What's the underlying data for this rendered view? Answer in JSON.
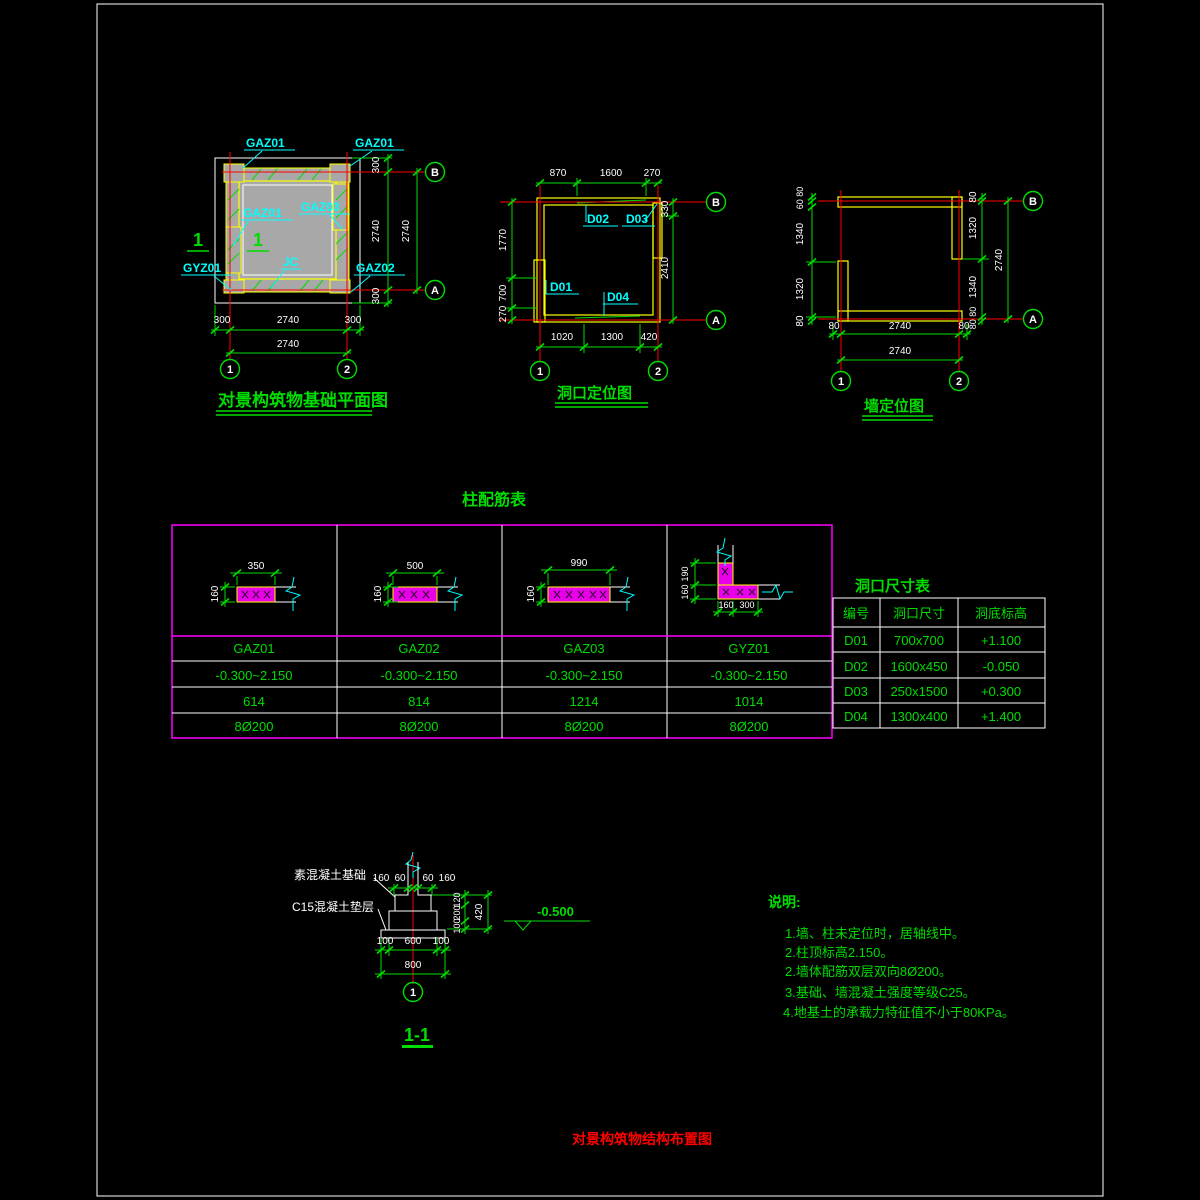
{
  "colors": {
    "background": "#000000",
    "green": "#00dd00",
    "cyan": "#00ffff",
    "red": "#ff0000",
    "yellow": "#ffff00",
    "magenta": "#ff00ff",
    "white": "#ffffff",
    "wall_gray": "#a8a8a8",
    "section_pink": "#e800e8"
  },
  "plans": {
    "foundation": {
      "title": "对景构筑物基础平面图",
      "labels": {
        "gaz01": "GAZ01",
        "gaz02": "GAZ02",
        "gaz03": "GAZ03",
        "gyz01": "GYZ01",
        "jc": "JC"
      },
      "section_mark": "1",
      "right_dims": [
        "300",
        "2740",
        "300"
      ],
      "right_total": "2740",
      "bottom_dims": [
        "300",
        "2740",
        "300"
      ],
      "bottom_total": "2740",
      "axes": {
        "a": "A",
        "b": "B",
        "n1": "1",
        "n2": "2"
      }
    },
    "opening": {
      "title": "洞口定位图",
      "top_dims": [
        "870",
        "1600",
        "270"
      ],
      "left_dims": [
        "1770",
        "700",
        "270"
      ],
      "right_dims": [
        "330",
        "2410"
      ],
      "bottom_dims": [
        "1020",
        "1300",
        "420"
      ],
      "doors": {
        "d01": "D01",
        "d02": "D02",
        "d03": "D03",
        "d04": "D04"
      },
      "axes": {
        "a": "A",
        "b": "B",
        "n1": "1",
        "n2": "2"
      }
    },
    "wall": {
      "title": "墙定位图",
      "left_dims": [
        "60 80",
        "1340",
        "1320",
        "80"
      ],
      "right_dims": [
        "80",
        "1320",
        "1340",
        "80 80"
      ],
      "right_total": "2740",
      "bottom_dims": [
        "80",
        "2740",
        "80"
      ],
      "bottom_total": "2740",
      "axes": {
        "a": "A",
        "b": "B",
        "n1": "1",
        "n2": "2"
      }
    }
  },
  "column_table": {
    "title": "柱配筋表",
    "columns": [
      {
        "name": "GAZ01",
        "width": "350",
        "height": "160",
        "range": "-0.300~2.150",
        "bars": "614",
        "stirrups": "8Ø200"
      },
      {
        "name": "GAZ02",
        "width": "500",
        "height": "160",
        "range": "-0.300~2.150",
        "bars": "814",
        "stirrups": "8Ø200"
      },
      {
        "name": "GAZ03",
        "width": "990",
        "height": "160",
        "range": "-0.300~2.150",
        "bars": "1214",
        "stirrups": "8Ø200"
      },
      {
        "name": "GYZ01",
        "v_dims": [
          "190",
          "160"
        ],
        "h_dims": [
          "160",
          "300"
        ],
        "range": "-0.300~2.150",
        "bars": "1014",
        "stirrups": "8Ø200"
      }
    ]
  },
  "opening_table": {
    "title": "洞口尺寸表",
    "headers": [
      "编号",
      "洞口尺寸",
      "洞底标高"
    ],
    "rows": [
      {
        "id": "D01",
        "size": "700x700",
        "elev": "+1.100"
      },
      {
        "id": "D02",
        "size": "1600x450",
        "elev": "-0.050"
      },
      {
        "id": "D03",
        "size": "250x1500",
        "elev": "+0.300"
      },
      {
        "id": "D04",
        "size": "1300x400",
        "elev": "+1.400"
      }
    ]
  },
  "section": {
    "title": "1-1",
    "label_footing": "素混凝土基础",
    "label_cushion": "C15混凝土垫层",
    "top_dims": [
      "160",
      "60",
      "60",
      "160"
    ],
    "right_dims": [
      "120",
      "200",
      "100"
    ],
    "right_total": "420",
    "level": "-0.500",
    "bottom_dims": [
      "100",
      "600",
      "100"
    ],
    "bottom_total": "800",
    "axis_bubble": "1"
  },
  "notes": {
    "title": "说明:",
    "items": [
      "1.墙、柱未定位时，居轴线中。",
      "2.柱顶标高2.150。",
      "2.墙体配筋双层双向8Ø200。",
      "3.基础、墙混凝土强度等级C25。",
      "4.地基土的承载力特征值不小于80KPa。"
    ]
  },
  "footer_title": "对景构筑物结构布置图"
}
